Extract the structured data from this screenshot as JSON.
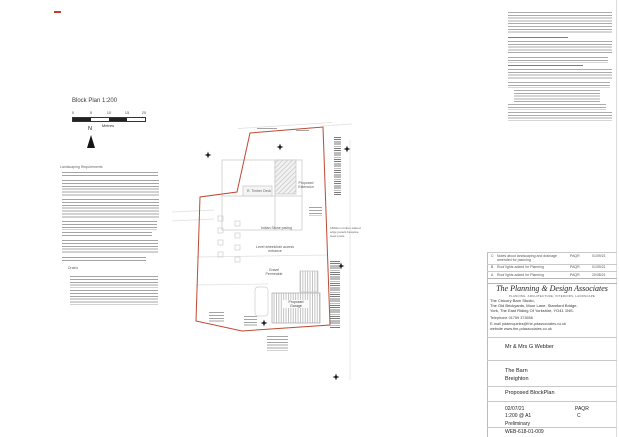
{
  "title": {
    "block_plan": "Block Plan 1:200"
  },
  "scale_bar": {
    "ticks": [
      "0",
      "5",
      "10",
      "15",
      "20"
    ],
    "unit": "Metres",
    "north": "N"
  },
  "left_notes": {
    "heading": "Landscaping Requirements",
    "drains_heading": "Drains"
  },
  "plan": {
    "labels": {
      "timber_deck": "R. Timber Deck",
      "extension_l1": "Proposed",
      "extension_l2": "Extension",
      "indian_stone": "Indian Stone paving",
      "wheelchair_l1": "Level wheelchair access",
      "wheelchair_l2": "entrance",
      "gravel_l1": "Gravel",
      "gravel_l2": "Permeable",
      "garage_l1": "Proposed",
      "garage_l2": "Garage",
      "fence_note": [
        "1800mm timber slatted",
        "edge panels bespoke",
        "steel posts"
      ]
    },
    "boundary_color": "#bf4a33"
  },
  "revisions": {
    "rows": [
      {
        "rev": "C",
        "desc": "Notes about landscaping and drainage amended for planning",
        "by": "PAQR",
        "date": "01/09/21"
      },
      {
        "rev": "B",
        "desc": "Roof lights added for Planning",
        "by": "PAQR",
        "date": "01/09/21"
      },
      {
        "rev": "A",
        "desc": "Roof lights added for Planning",
        "by": "PAQR",
        "date": "20/08/21"
      }
    ]
  },
  "title_block": {
    "company": "The Planning & Design Associates",
    "tagline": "PLANNING, ARCHITECTURE, INTERIORS, LANDSCAPE",
    "address1": "The Chicory Barn Studio,",
    "address2": "The Old Brickyards, Moor Lane, Stamford Bridge,",
    "address3": "York, The East Riding Of Yorkshire, YO41 1NS.",
    "telephone": "Telephone 01759 373656",
    "email": "E-mail pdaenquiries@the-pdassociates.co.uk",
    "website": "website www.the-pdassociates.co.uk",
    "client": "Mr & Mrs G Webber",
    "project_l1": "The Barn",
    "project_l2": "Breighton",
    "drawing_title": "Proposed BlockPlan",
    "date": "02/07/21",
    "drawn_by": "PAQR",
    "scale": "1:200 @ A1",
    "revision": "C",
    "status": "Preliminary",
    "drawing_no": "WEB-618-01-009"
  }
}
